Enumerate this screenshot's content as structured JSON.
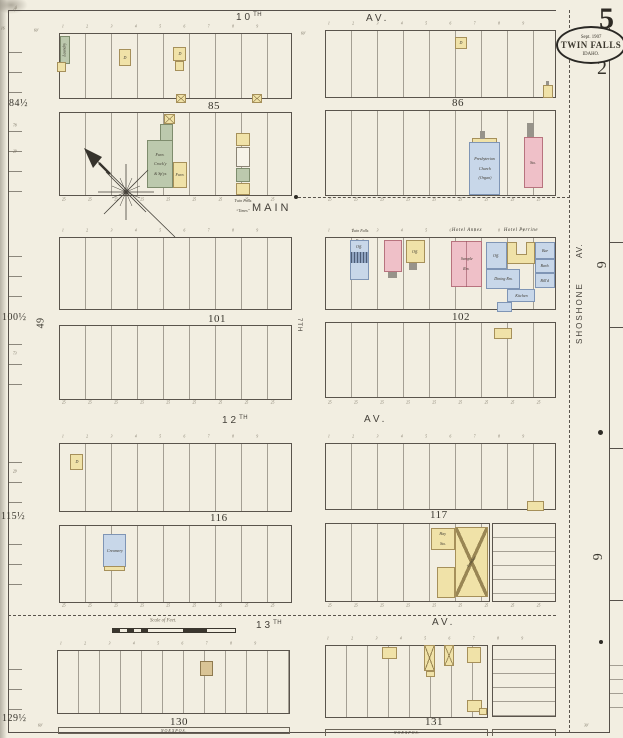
{
  "sheet": {
    "number": "5",
    "secondary_number": "2",
    "stamp": {
      "date": "Sept. 1907",
      "city": "TWIN FALLS",
      "state": "IDAHO."
    }
  },
  "streets": {
    "av10_num": "10",
    "av10_sup": "TH",
    "av10_av": "AV.",
    "main": "MAIN",
    "av12_num": "12",
    "av12_sup": "TH",
    "av12_av": "AV.",
    "av13_num": "13",
    "av13_sup": "TH",
    "av13_av": "AV.",
    "av7": "7TH",
    "shoshone": "SHOSHONE",
    "shoshone_av": "AV."
  },
  "blocks": {
    "b84": "84½",
    "b85": "85",
    "b86": "86",
    "b100": "100½",
    "b101": "101",
    "b102": "102",
    "b115": "115½",
    "b116": "116",
    "b117": "117",
    "b129": "129½",
    "b130": "130",
    "b131": "131"
  },
  "margin_numbers": {
    "six_upper": "6",
    "six_lower": "6",
    "forty_nine": "49"
  },
  "buildings": {
    "laundry": "Laundry",
    "furniture_line1": "Furn.",
    "furniture_line2": "Crock'y",
    "furniture_line3": "& Sp'ys",
    "furn": "Furn.",
    "times_line1": "Twin Falls",
    "times_line2": "“Times”",
    "church_line1": "Presbyterian",
    "church_line2": "Church",
    "church_line3": "(Organ)",
    "store": "Sto.",
    "bank_label_line1": "Twin Falls",
    "bank_label_line2": "Bank",
    "office": "Off.",
    "hotel_annex": "Hotel Annex",
    "sample_line1": "Sample",
    "sample_line2": "Rm.",
    "hotel_perrine": "Hotel Perrine",
    "bar": "Bar",
    "barber": "Barb.",
    "billiards": "Bill'd",
    "dining": "Dining Rm.",
    "kitchen": "Kitchen",
    "creamery": "Creamery",
    "hay_line1": "Hay",
    "hay_line2": "Sto.",
    "lumber": "Lumber",
    "dwelling": "D"
  },
  "annotations": {
    "scale_label": "Scale of Feet.",
    "expos": "N O   E X P O S .",
    "lot_numbers": "1 2 3 4 5 6 7 8 9",
    "lot_dims": "25 25 25 25 25 25 25 25 25",
    "d150": "150'",
    "d60": "60'",
    "d30": "30'",
    "d16": "16",
    "d78": "78",
    "d29": "29",
    "d73": "73"
  }
}
